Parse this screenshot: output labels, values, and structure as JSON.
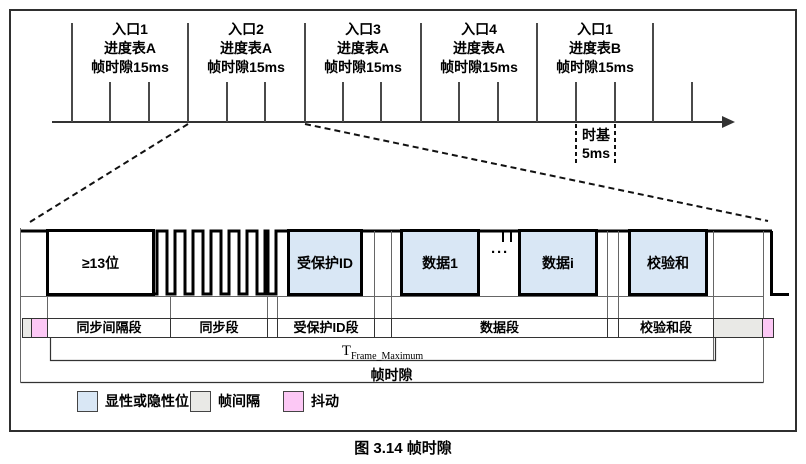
{
  "figure": {
    "caption": "图 3.14 帧时隙"
  },
  "timeline": {
    "entries": [
      {
        "line1": "入口1",
        "line2": "进度表A",
        "line3": "帧时隙15ms"
      },
      {
        "line1": "入口2",
        "line2": "进度表A",
        "line3": "帧时隙15ms"
      },
      {
        "line1": "入口3",
        "line2": "进度表A",
        "line3": "帧时隙15ms"
      },
      {
        "line1": "入口4",
        "line2": "进度表A",
        "line3": "帧时隙15ms"
      },
      {
        "line1": "入口1",
        "line2": "进度表B",
        "line3": "帧时隙15ms"
      }
    ],
    "time_base": {
      "line1": "时基",
      "line2": "5ms"
    }
  },
  "frame": {
    "break_field": "≥13位",
    "fields": {
      "pid": "受保护ID",
      "data1": "数据1",
      "ellipsis": "···",
      "datai": "数据i",
      "checksum": "校验和"
    },
    "segments": {
      "sync_break": "同步间隔段",
      "sync": "同步段",
      "pid": "受保护ID段",
      "data": "数据段",
      "checksum": "校验和段"
    },
    "t_frame_max": {
      "main": "T",
      "sub": "Frame_Maximum"
    },
    "frame_slot": "帧时隙"
  },
  "legend": {
    "items": [
      {
        "label": "显性或隐性位",
        "color": "#d9e7f5"
      },
      {
        "label": "帧间隔",
        "color": "#e9e9e6"
      },
      {
        "label": "抖动",
        "color": "#fcc8f5"
      }
    ]
  },
  "colors": {
    "field_blue": "#d9e7f5",
    "gray": "#e9e9e6",
    "pink": "#fcc8f5"
  }
}
